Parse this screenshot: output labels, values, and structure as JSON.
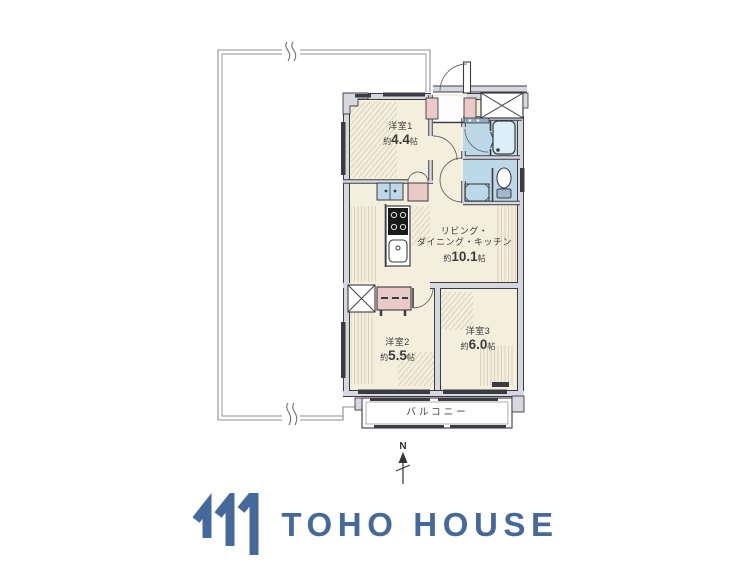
{
  "plan": {
    "rooms": [
      {
        "id": "bedroom1",
        "name": "洋室1",
        "size_prefix": "約",
        "size_value": "4.4",
        "size_unit": "帖"
      },
      {
        "id": "ldk",
        "name_line1": "リビング・",
        "name_line2": "ダイニング・キッチン",
        "size_prefix": "約",
        "size_value": "10.1",
        "size_unit": "帖"
      },
      {
        "id": "bedroom2",
        "name": "洋室2",
        "size_prefix": "約",
        "size_value": "5.5",
        "size_unit": "帖"
      },
      {
        "id": "bedroom3",
        "name": "洋室3",
        "size_prefix": "約",
        "size_value": "6.0",
        "size_unit": "帖"
      }
    ],
    "balcony_label": "バルコニー",
    "compass_label": "N"
  },
  "branding": {
    "logo_text": "TOHO HOUSE"
  },
  "colors": {
    "room_floor": "#f4eedd",
    "closet_pink": "#eac9c9",
    "sanitary_blue": "#bdd9e9",
    "wall_fill": "#d7d7df",
    "wall_line": "#3b3b42",
    "boundary_line": "#8f8f8f",
    "logo_blue": "#46699c"
  }
}
